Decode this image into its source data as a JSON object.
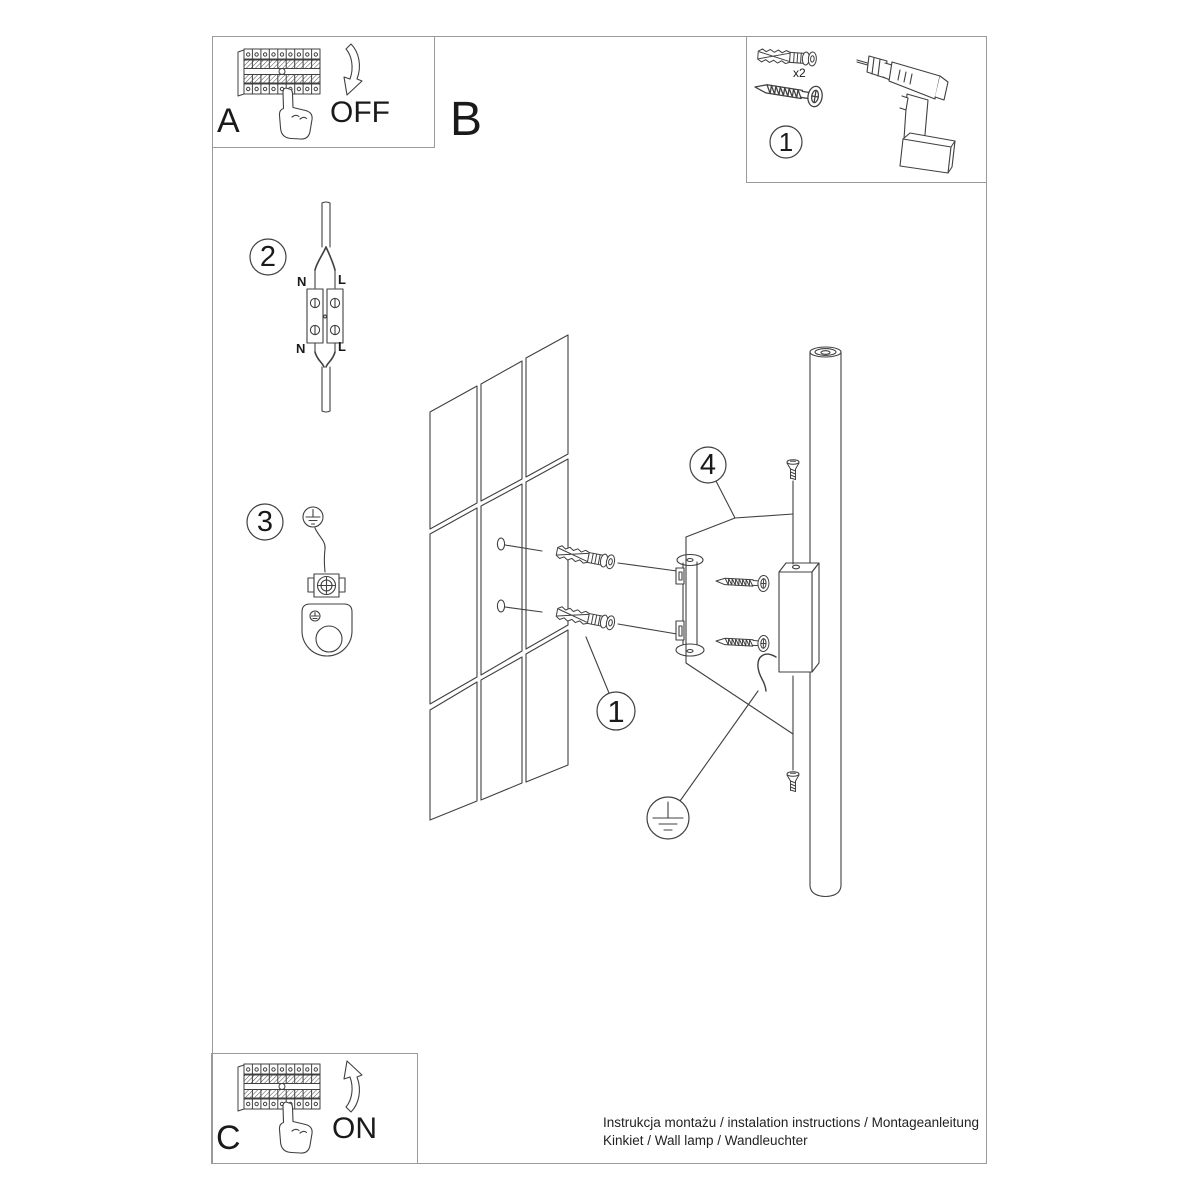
{
  "panels": {
    "a_label": "A",
    "b_label": "B",
    "c_label": "C",
    "off_label": "OFF",
    "on_label": "ON"
  },
  "toolbox": {
    "step_number": "1",
    "anchor_quantity": "x2"
  },
  "steps": {
    "anchors_step": "1",
    "wiring_step": "2",
    "ground_step": "3",
    "fix_screws_step": "4"
  },
  "wiring": {
    "neutral_top": "N",
    "line_top": "L",
    "neutral_bottom": "N",
    "line_bottom": "L"
  },
  "footer": {
    "line1": "Instrukcja montażu / instalation instructions / Montageanleitung",
    "line2": "Kinkiet / Wall lamp / Wandleuchter"
  },
  "colors": {
    "line_art": "#404040",
    "frame_border": "#9a9a9a",
    "text": "#1a1a1a"
  }
}
